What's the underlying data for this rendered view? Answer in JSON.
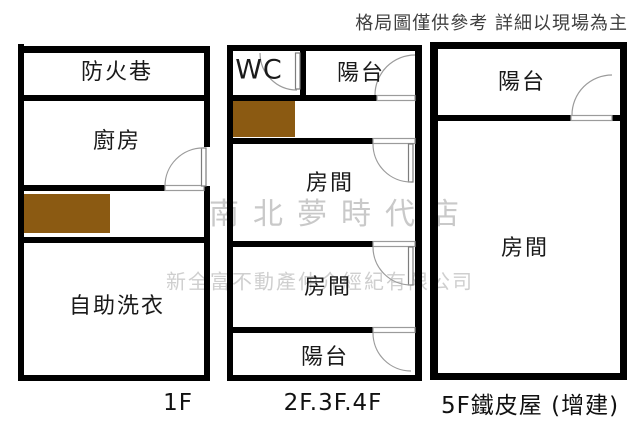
{
  "disclaimer": "格局圖僅供參考 詳細以現場為主",
  "watermark": {
    "store": "南北夢時代店",
    "company": "新全富不動產仲介經紀有限公司"
  },
  "colors": {
    "wall": "#000000",
    "stairs": "#8b5a12",
    "watermark": "#c9c9c9",
    "door_line": "#9b9b9b",
    "label_text": "#1a1a1a"
  },
  "plans": [
    {
      "floor_label": "1F",
      "rooms": [
        {
          "label": "防火巷"
        },
        {
          "label": "廚房"
        },
        {
          "label": "自助洗衣"
        }
      ]
    },
    {
      "floor_label": "2F.3F.4F",
      "rooms": [
        {
          "label": "WC"
        },
        {
          "label": "陽台"
        },
        {
          "label": "房間"
        },
        {
          "label": "房間"
        },
        {
          "label": "陽台"
        }
      ]
    },
    {
      "floor_label": "5F鐵皮屋 (增建)",
      "rooms": [
        {
          "label": "陽台"
        },
        {
          "label": "房間"
        }
      ]
    }
  ]
}
